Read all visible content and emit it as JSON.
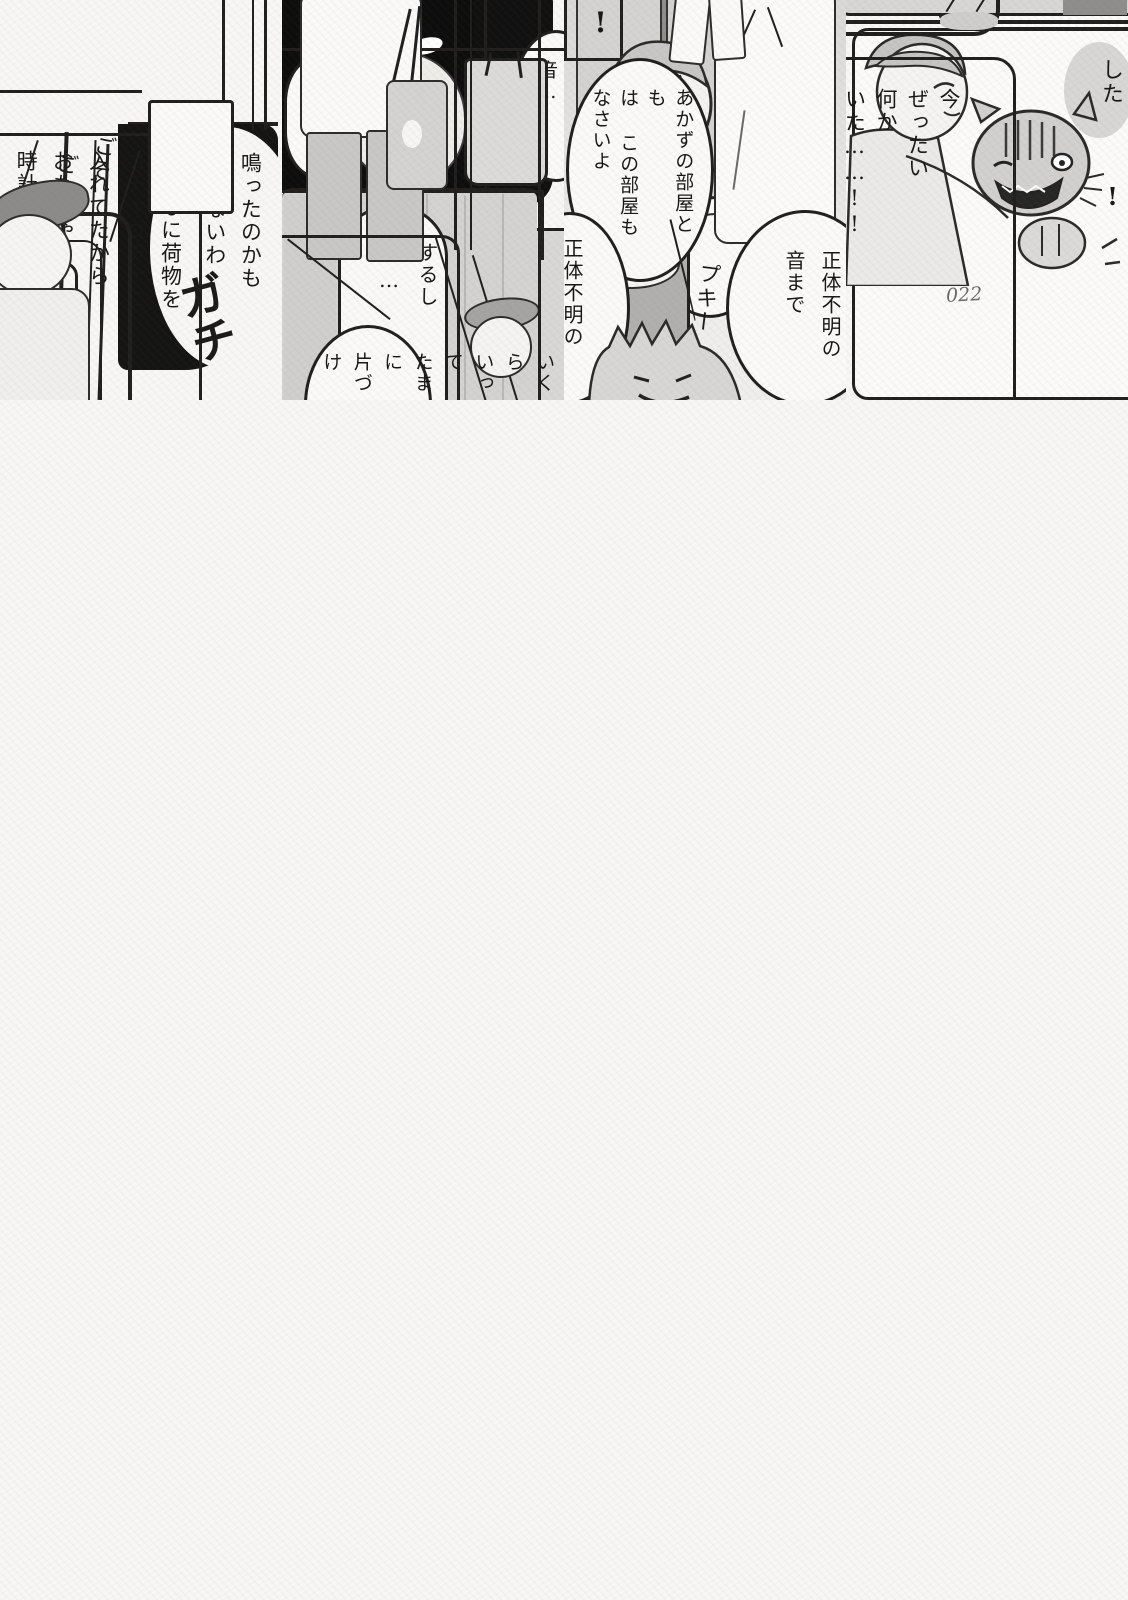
{
  "page_number": "022",
  "dialogue": {
    "maybe_rang": "鳴ったのかも\nしれないわ",
    "luggage_reason": "あんなに荷物を\nゴチャゴチャに\n入れてたから\nおもちゃや\n時計のアラーム音が",
    "sound": "音…",
    "earlier": "さっきの",
    "does_too": "するし\n……",
    "shita_fragment": "した",
    "exclamation_fragment": "!",
    "unknown_sound": "正体不明の\n音まで",
    "unknown_half": "正体不明の",
    "locked_room": "あかずの部屋と\nも\nは この部屋も\nなさいよ",
    "just_now": "今\nぜったい\n何か\nいた……!!",
    "tidy_up": "いくら\nいって\nたまに\n片づけ",
    "exclamation_panel": "!"
  },
  "sfx": {
    "pii_main": "ピ",
    "pii_small": "ィ",
    "patan": "パタン",
    "goso1": "ごそ",
    "goso2": "ごそ",
    "mozo1": "モゾ",
    "mozo2": "モゾ",
    "gachi": "ガチ",
    "pukii": "プキー"
  }
}
